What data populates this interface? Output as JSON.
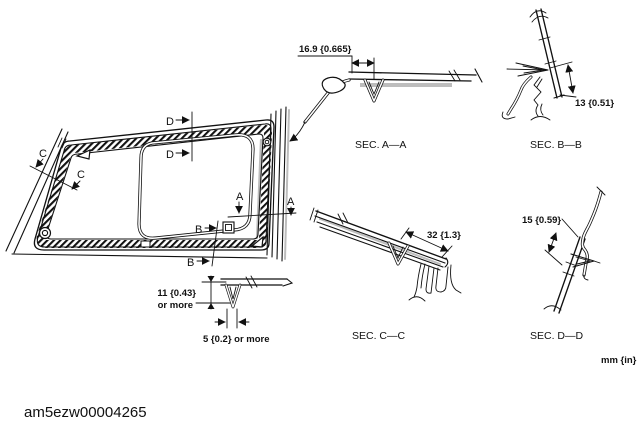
{
  "figure": {
    "caption": "am5ezw00004265",
    "units": "mm {in}"
  },
  "main_view": {
    "markers": {
      "a": "A",
      "b": "B",
      "c": "C",
      "d": "D"
    },
    "bead_detail": {
      "height_value": "11 {0.43}",
      "height_note": "or more",
      "width_value": "5 {0.2} or more"
    }
  },
  "sections": [
    {
      "label": "SEC. A—A",
      "dimension": "16.9 {0.665}"
    },
    {
      "label": "SEC. B—B",
      "dimension": "13 {0.51}"
    },
    {
      "label": "SEC. C—C",
      "dimension": "32 {1.3}"
    },
    {
      "label": "SEC. D—D",
      "dimension": "15 {0.59}"
    }
  ]
}
